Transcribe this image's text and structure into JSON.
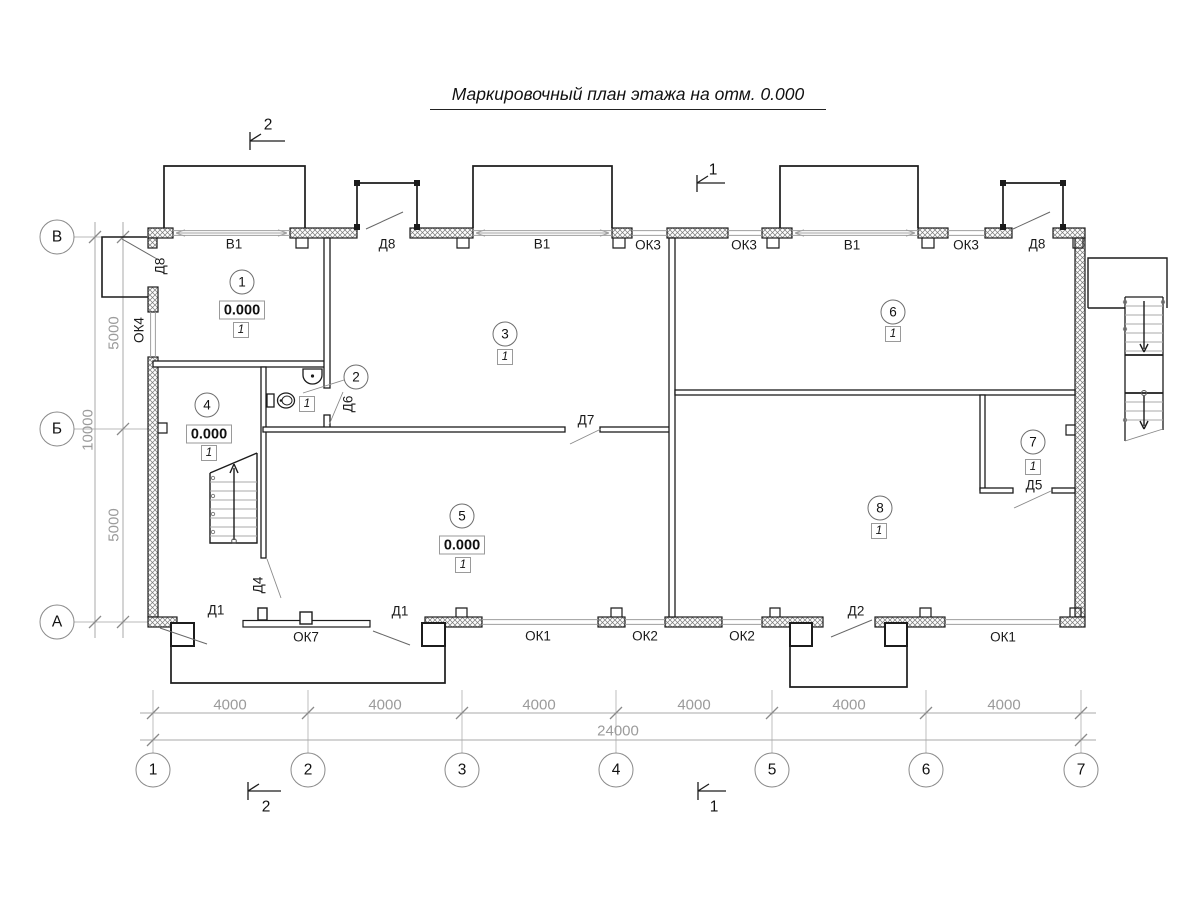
{
  "title": "Маркировочный план этажа на отм. 0.000",
  "axes": {
    "cols": [
      {
        "label": "1"
      },
      {
        "label": "2"
      },
      {
        "label": "3"
      },
      {
        "label": "4"
      },
      {
        "label": "5"
      },
      {
        "label": "6"
      },
      {
        "label": "7"
      }
    ],
    "rows": [
      {
        "label": "В"
      },
      {
        "label": "Б"
      },
      {
        "label": "А"
      }
    ]
  },
  "dims": {
    "col_segments": [
      "4000",
      "4000",
      "4000",
      "4000",
      "4000",
      "4000"
    ],
    "col_total": "24000",
    "row_segments": [
      "5000",
      "5000"
    ],
    "row_total": "10000"
  },
  "rooms": [
    {
      "number": "1",
      "elevation": "0.000",
      "finish": "1"
    },
    {
      "number": "2",
      "finish": "1"
    },
    {
      "number": "3",
      "finish": "1"
    },
    {
      "number": "4",
      "elevation": "0.000",
      "finish": "1"
    },
    {
      "number": "5",
      "elevation": "0.000",
      "finish": "1"
    },
    {
      "number": "6",
      "finish": "1"
    },
    {
      "number": "7",
      "finish": "1"
    },
    {
      "number": "8",
      "finish": "1"
    }
  ],
  "openings": {
    "top": [
      {
        "label": "В1"
      },
      {
        "label": "Д8"
      },
      {
        "label": "В1"
      },
      {
        "label": "ОК3"
      },
      {
        "label": "ОК3"
      },
      {
        "label": "В1"
      },
      {
        "label": "ОК3"
      },
      {
        "label": "Д8"
      }
    ],
    "left": [
      {
        "label": "Д8"
      },
      {
        "label": "ОК4"
      }
    ],
    "bottom": [
      {
        "label": "Д1"
      },
      {
        "label": "ОК7"
      },
      {
        "label": "Д1"
      },
      {
        "label": "ОК1"
      },
      {
        "label": "ОК2"
      },
      {
        "label": "ОК2"
      },
      {
        "label": "Д2"
      },
      {
        "label": "ОК1"
      }
    ],
    "interior": [
      {
        "label": "Д6"
      },
      {
        "label": "Д7"
      },
      {
        "label": "Д4"
      },
      {
        "label": "Д5"
      }
    ]
  },
  "section_marks": [
    {
      "label": "2"
    },
    {
      "label": "1"
    },
    {
      "label": "2"
    },
    {
      "label": "1"
    }
  ]
}
